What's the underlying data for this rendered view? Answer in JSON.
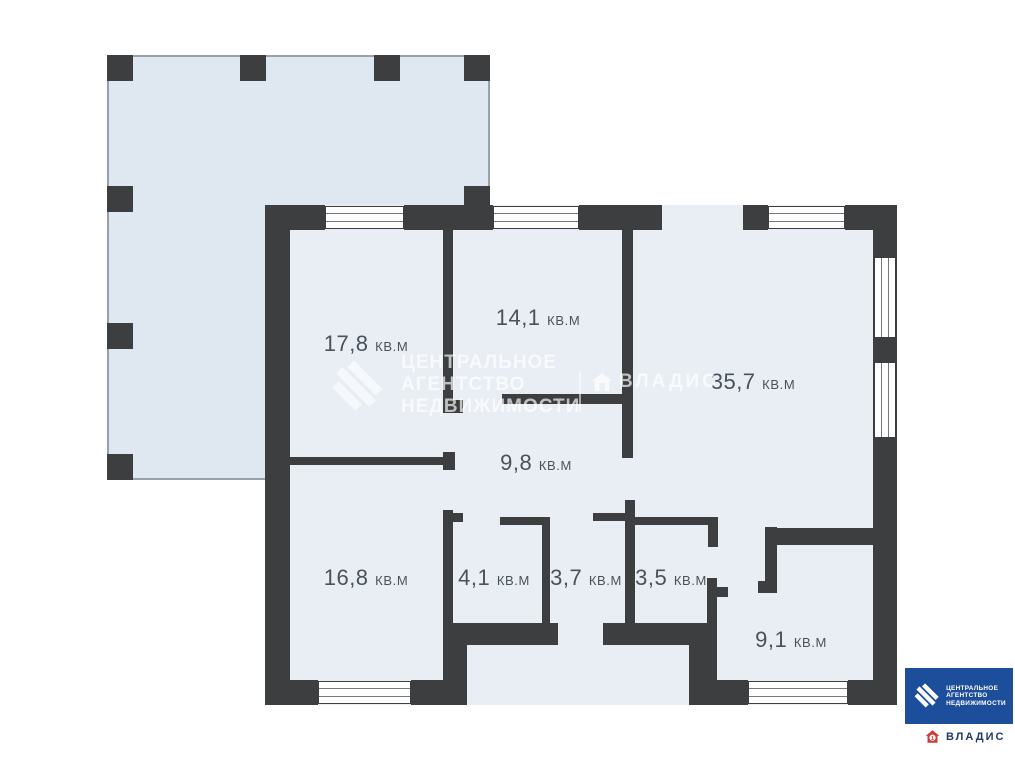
{
  "plan": {
    "unit_label": "кв.м",
    "rooms": [
      {
        "id": "room-17-8",
        "area": "17,8",
        "unit": "кв.м"
      },
      {
        "id": "room-14-1",
        "area": "14,1",
        "unit": "кв.м"
      },
      {
        "id": "room-35-7",
        "area": "35,7",
        "unit": "кв.м"
      },
      {
        "id": "room-9-8",
        "area": "9,8",
        "unit": "кв.м"
      },
      {
        "id": "room-16-8",
        "area": "16,8",
        "unit": "кв.м"
      },
      {
        "id": "room-4-1",
        "area": "4,1",
        "unit": "кв.м"
      },
      {
        "id": "room-3-7",
        "area": "3,7",
        "unit": "кв.м"
      },
      {
        "id": "room-3-5",
        "area": "3,5",
        "unit": "кв.м"
      },
      {
        "id": "room-9-1",
        "area": "9,1",
        "unit": "кв.м"
      }
    ]
  },
  "colors": {
    "wall": "#3d3e40",
    "room_fill": "#e8eef4",
    "terrace_fill": "#dfe8f0",
    "agency_blue": "#1d4e9b",
    "vladis_red": "#d23b35",
    "vladis_navy": "#21386b"
  },
  "watermarks": {
    "agency": {
      "lines": [
        "ЦЕНТРАЛЬНОЕ",
        "АГЕНТСТВО",
        "НЕДВИЖИМОСТИ"
      ]
    },
    "vladis": "ВЛАДИС"
  },
  "footer": {
    "agency_lines": [
      "ЦЕНТРАЛЬНОЕ",
      "АГЕНТСТВО",
      "НЕДВИЖИМОСТИ"
    ],
    "vladis_label": "ВЛАДИС"
  }
}
